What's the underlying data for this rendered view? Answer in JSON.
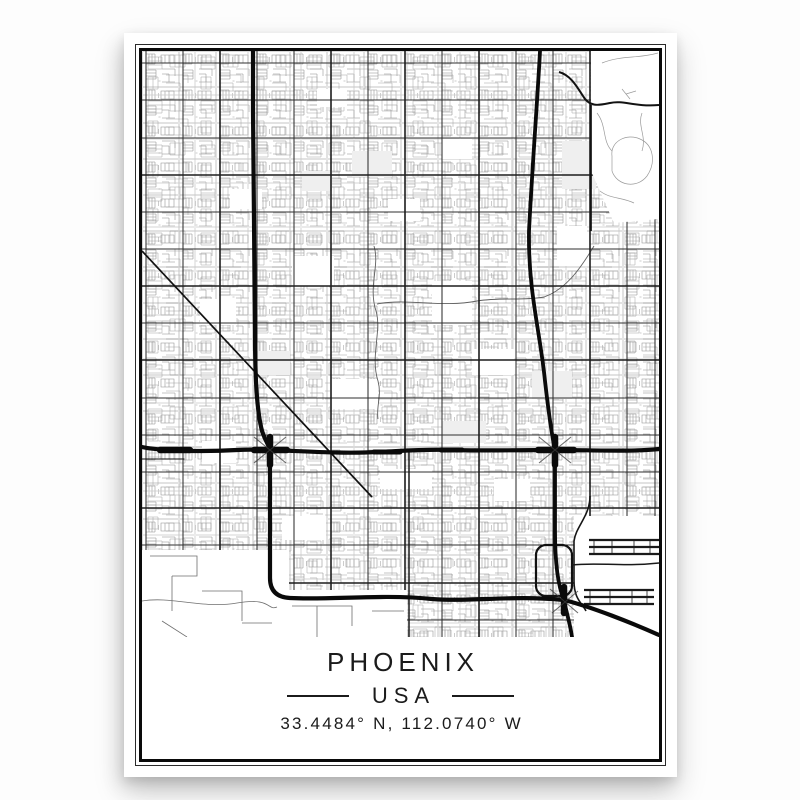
{
  "poster": {
    "city": "PHOENIX",
    "country": "USA",
    "coordinates": "33.4484° N, 112.0740° W"
  },
  "map": {
    "kind": "monochrome street map print",
    "features": [
      "street-grid",
      "highways",
      "diagonal-avenue",
      "mountain-preserve",
      "airport-runways",
      "airport-terminal-loop"
    ]
  },
  "style": {
    "paper": "#ffffff",
    "ink": "#111111",
    "minor_road_gray": "#8d8d8d",
    "arterial_gray": "#2f2f2f",
    "frame_outer_color": "#2a2a2a",
    "frame_inner_color": "#0a0a0a"
  }
}
